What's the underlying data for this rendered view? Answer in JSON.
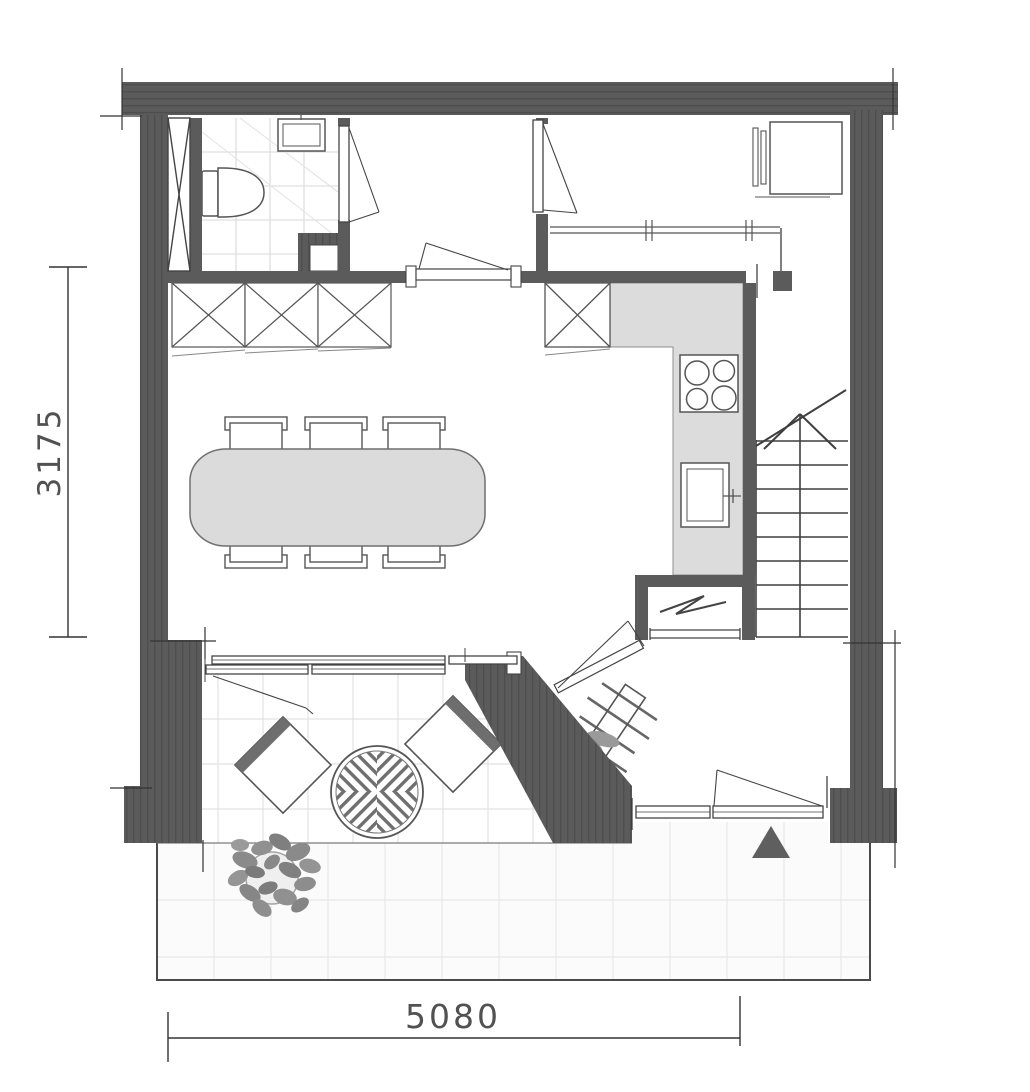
{
  "plan": {
    "type": "architectural-floor-plan",
    "dimension_labels": {
      "left_vertical": "3175",
      "bottom_horizontal": "5080"
    }
  },
  "palette": {
    "background": "#ffffff",
    "wall_fill": "#5b5b5b",
    "wall_stripe": "#4e4e4e",
    "line": "#3f3f3f",
    "counter_fill": "#dcdcdc",
    "table_fill": "#dbdbdb",
    "tile_line": "#e2e2e2",
    "terrace_fill": "#fbfbfb",
    "plant_leaf": "#8a8a8a",
    "entrance_marker": "#5f5f5f",
    "dim_text": "#333333"
  },
  "icons": [
    {
      "name": "shaft-x-icon"
    },
    {
      "name": "toilet-icon"
    },
    {
      "name": "washbasin-icon"
    },
    {
      "name": "duct-niche-icon"
    },
    {
      "name": "door-swing-icon"
    },
    {
      "name": "wardrobe-x-icon"
    },
    {
      "name": "clothes-rail-icon"
    },
    {
      "name": "washing-machine-icon"
    },
    {
      "name": "tall-cabinet-x-icon"
    },
    {
      "name": "hob-icon"
    },
    {
      "name": "sink-icon"
    },
    {
      "name": "boiler-zigzag-icon"
    },
    {
      "name": "staircase-icon"
    },
    {
      "name": "dining-table-icon"
    },
    {
      "name": "dining-chair-icon"
    },
    {
      "name": "sliding-window-icon"
    },
    {
      "name": "lounge-chair-icon"
    },
    {
      "name": "round-rattan-table-icon"
    },
    {
      "name": "coat-rack-icon"
    },
    {
      "name": "entrance-door-icon"
    },
    {
      "name": "entrance-arrow-icon"
    },
    {
      "name": "plant-icon"
    },
    {
      "name": "terrace-tiles"
    },
    {
      "name": "dimension-line-icon"
    }
  ]
}
